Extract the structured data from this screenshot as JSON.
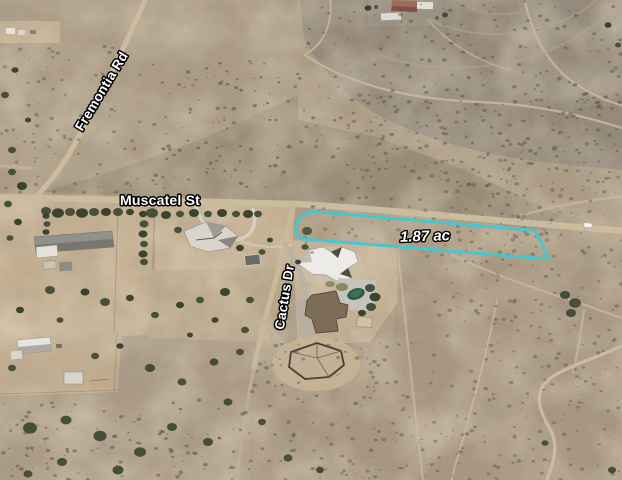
{
  "map": {
    "type": "satellite-aerial-view",
    "scene": "Desert residential neighborhood with dirt roads and an outlined vacant land parcel",
    "road_labels": [
      {
        "id": "fremontia",
        "label": "Fremontia Rd"
      },
      {
        "id": "muscatel",
        "label": "Muscatel St"
      },
      {
        "id": "cactus",
        "label": "Cactus Dr"
      }
    ],
    "parcel": {
      "area_label": "1.87 ac",
      "outline_color": "#3FC9D4",
      "label_text_color": "#FFFFFF",
      "label_outline_color": "#000000"
    }
  }
}
